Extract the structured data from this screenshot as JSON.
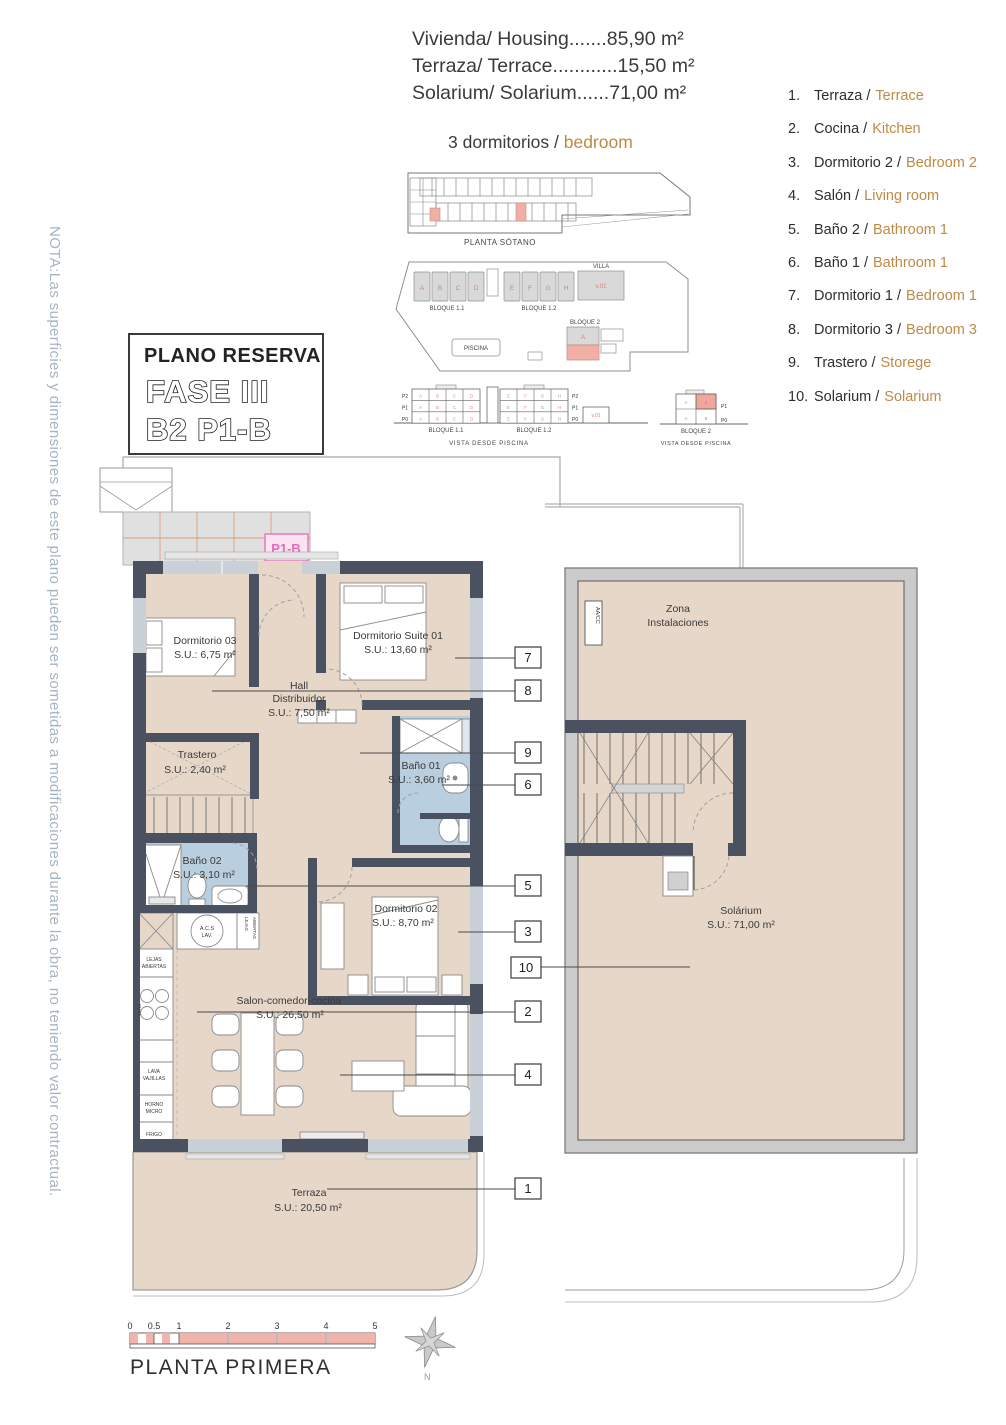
{
  "header": {
    "line1": "Vivienda/ Housing.......85,90 m²",
    "line2": "Terraza/ Terrace............15,50 m²",
    "line3": "Solarium/ Solarium......71,00 m²",
    "bedrooms_es": "3 dormitorios / ",
    "bedrooms_en": "bedroom"
  },
  "legend": {
    "items": [
      {
        "num": "1.",
        "es": "Terraza /",
        "en": "Terrace"
      },
      {
        "num": "2.",
        "es": "Cocina /",
        "en": "Kitchen"
      },
      {
        "num": "3.",
        "es": "Dormitorio 2 /",
        "en": "Bedroom 2"
      },
      {
        "num": "4.",
        "es": "Salón /",
        "en": "Living room"
      },
      {
        "num": "5.",
        "es": "Baño 2 /",
        "en": "Bathroom 1"
      },
      {
        "num": "6.",
        "es": "Baño 1 /",
        "en": "Bathroom 1"
      },
      {
        "num": "7.",
        "es": "Dormitorio 1 /",
        "en": "Bedroom 1"
      },
      {
        "num": "8.",
        "es": "Dormitorio 3 /",
        "en": "Bedroom 3"
      },
      {
        "num": "9.",
        "es": "Trastero /",
        "en": "Storege"
      },
      {
        "num": "10.",
        "es": "Solarium /",
        "en": "Solarium"
      }
    ]
  },
  "title_box": {
    "title": "PLANO RESERVA",
    "fase": "FASE III",
    "unit": "B2 P1-B"
  },
  "note": "NOTA:Las superficies y dimensiones de este plano pueden ser sometidas a modificaciones durante la obra, no teniendo valor contractual.",
  "site": {
    "planta_sotano": "PLANTA SÓTANO",
    "bloque11": "BLOQUE 1.1",
    "bloque12": "BLOQUE 1.2",
    "bloque11_elev": "BLOQUE 1.1",
    "bloque12_elev": "BLOQUE 1.2",
    "villa": "VILLA",
    "v01": "v.01",
    "v01_elev": "v.01",
    "bloque2": "BLOQUE 2",
    "bloque2_elev": "BLOQUE 2",
    "piscina": "PISCINA",
    "vista1": "VISTA DESDE PISCINA",
    "vista2": "VISTA DESDE PISCINA",
    "units_b11": [
      "A",
      "B",
      "C",
      "D"
    ],
    "units_b12": [
      "E",
      "F",
      "G",
      "H"
    ],
    "floors": [
      "P2",
      "P1",
      "P0"
    ],
    "floors_b2": [
      "P1",
      "P0"
    ],
    "b2_letters": [
      "A",
      "B",
      "A",
      "B"
    ],
    "b2_site_unit": "A"
  },
  "plan": {
    "p1b": "P1-B",
    "rooms": {
      "dorm03_name": "Dormitorio 03",
      "dorm03_area": "S.U.: 6,75 m²",
      "suite_name": "Dormitorio Suite 01",
      "suite_area": "S.U.: 13,60 m²",
      "hall_1": "Hall",
      "hall_2": "Distribuidor",
      "hall_area": "S.U.: 7,50 m²",
      "trastero_name": "Trastero",
      "trastero_area": "S.U.: 2,40 m²",
      "bano01_name": "Baño 01",
      "bano01_area": "S.U.: 3,60 m²",
      "bano02_name": "Baño 02",
      "bano02_area": "S.U.: 3,10 m²",
      "dorm02_name": "Dormitorio 02",
      "dorm02_area": "S.U.: 8,70 m²",
      "salon_name": "Salon-comedor-cocina",
      "salon_area": "S.U.: 26,50 m²",
      "terraza_name": "Terraza",
      "terraza_area": "S.U.: 20,50 m²",
      "solarium_name": "Solárium",
      "solarium_area": "S.U.: 71,00 m²",
      "zona_1": "Zona",
      "zona_2": "Instalaciones"
    },
    "kitchen": {
      "acs_1": "A.C.S",
      "acs_2": "LAV.",
      "lejas_1": "LEJAS",
      "lejas_2": "ABIERTAS",
      "vert_1": "LEJAS",
      "vert_2": "ABIERTAS",
      "vitro": "VITRO",
      "lava_1": "LAVA",
      "lava_2": "VAJILLAS",
      "horno_1": "HORNO",
      "horno_2": "MICRO",
      "frigo": "FRIGO",
      "aacc": "AA/CC"
    },
    "callouts": [
      "7",
      "8",
      "9",
      "6",
      "5",
      "3",
      "10",
      "2",
      "4",
      "1"
    ]
  },
  "footer": {
    "scale_ticks": [
      "0",
      "0.5",
      "1",
      "2",
      "3",
      "4",
      "5"
    ],
    "plan_label": "PLANTA PRIMERA",
    "north": "N"
  },
  "colors": {
    "wall": "#4a5261",
    "floor": "#e7d7c8",
    "bathroom": "#b9cede",
    "site_highlight": "#f2afa6",
    "p1b_pink": "#e36bb5",
    "legend_en": "#bf8a45",
    "note_text": "#a6b5c4",
    "scalebar_pink": "#f2b3ab"
  }
}
